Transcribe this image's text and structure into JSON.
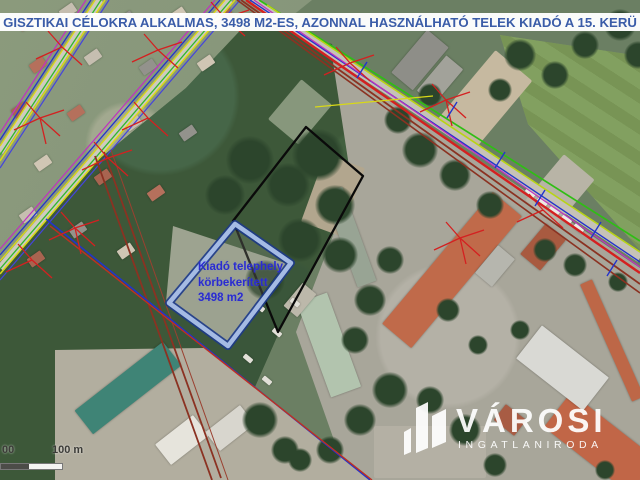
{
  "banner": {
    "text": "GISZTIKAI CÉLOKRA ALKALMAS, 3498 M2-ES, AZONNAL HASZNÁLHATÓ TELEK KIADÓ A 15. KERÜ",
    "text_color": "#3a5ca8",
    "background_color": "#ffffff"
  },
  "parcel": {
    "label_line1": "Kiadó telephely",
    "label_line2": "körbekerített",
    "label_line3": "3498 m2",
    "area_m2": "3498",
    "outline_color": "#a5bbe4",
    "outline_edge_color": "#1d3a8a",
    "label_color": "#2b2bd0"
  },
  "boundary": {
    "outline_color": "#0a0a0a"
  },
  "scale_bar": {
    "left_label": "00",
    "right_label": "100 m"
  },
  "logo": {
    "name": "VÁROSI",
    "subtitle": "INGATLANIRODA",
    "color": "#ffffff"
  },
  "overlay_colors": {
    "utility_yellow": "#d8d818",
    "utility_green": "#2db82d",
    "utility_blue": "#2233cc",
    "utility_red": "#d42020",
    "utility_dark_red": "#8b3222",
    "utility_magenta": "#c030c0"
  }
}
